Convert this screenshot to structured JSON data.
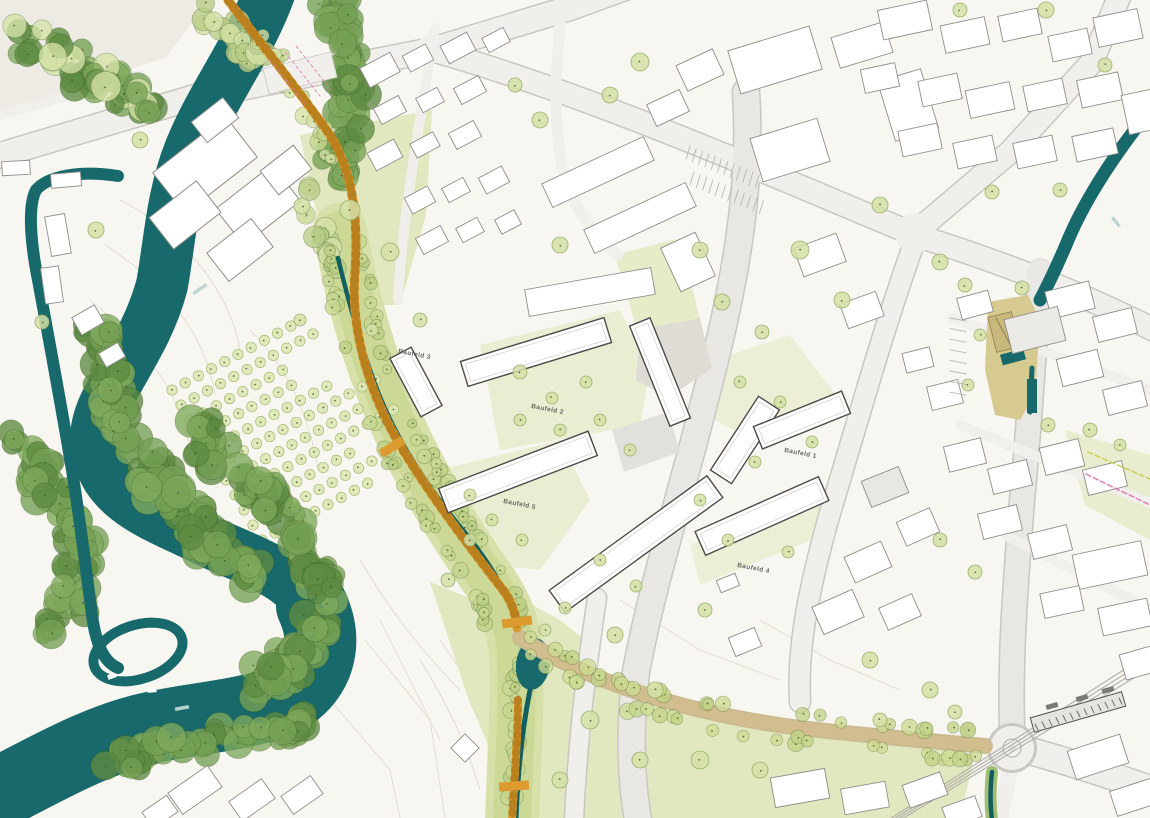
{
  "map": {
    "kind": "urban-masterplan-siteplan",
    "labels": [
      {
        "id": "baufeld-3",
        "text": "Baufeld 3"
      },
      {
        "id": "baufeld-2",
        "text": "Baufeld 2"
      },
      {
        "id": "baufeld-5",
        "text": "Baufeld 5"
      },
      {
        "id": "baufeld-1",
        "text": "Baufeld 1"
      },
      {
        "id": "baufeld-4",
        "text": "Baufeld 4"
      }
    ],
    "colors": {
      "background": "#f8f6f0",
      "river": "#17696b",
      "stream": "#135f60",
      "forest": "#74a055",
      "forest_dark": "#5d8a41",
      "tree_light": "#d5e1a6",
      "tree_edge": "#9ab06d",
      "meadow": "#e1e8c0",
      "corridor": "#ccd996",
      "orchard": "#dde7b4",
      "orchard_edge": "#a8bb78",
      "road_fill": "#f0efec",
      "road_casing": "#c9c7c1",
      "road_minor": "#e8e7e3",
      "building_fill": "#ffffff",
      "building_edge": "#8e8d89",
      "new_building_edge": "#4b4b48",
      "path_orange": "#dd9a2e",
      "path_orange_dark": "#b2791a",
      "avenue_tan": "#d2bd8e",
      "plaza_khaki": "#d7ca90",
      "rail": "#b4b2ad",
      "mark_pink": "#e070b0",
      "mark_yellow": "#c9cf4e"
    }
  }
}
